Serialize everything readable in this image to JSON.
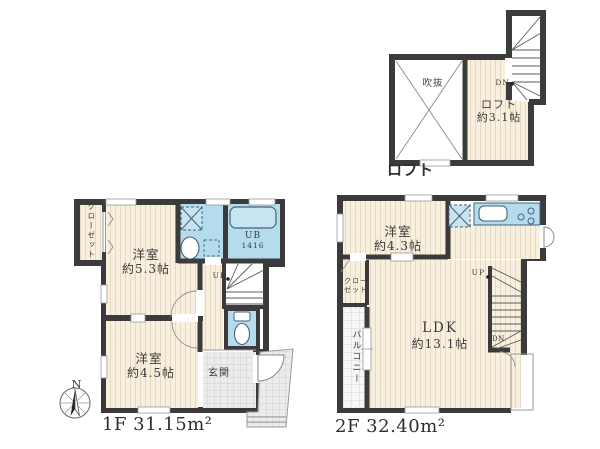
{
  "colors": {
    "wall": "#3b3b3b",
    "floor": "#f8efde",
    "floor_stripe": "#e4d9c2",
    "wet_area": "#b5dcec",
    "wet_outline": "#41637a",
    "tile_bg": "#ececec",
    "tile_line": "#c8c8c8",
    "text": "#3a3a3a"
  },
  "loft": {
    "plan_title": "ロフト",
    "void_label": "吹抜",
    "room_label": "ロフト",
    "room_size": "約3.1帖",
    "dn_label": "DN"
  },
  "floor1": {
    "area_label": "1F 31.15m²",
    "closet_label": "クローゼット",
    "room1_label": "洋室",
    "room1_size": "約5.3帖",
    "room2_label": "洋室",
    "room2_size": "約4.5帖",
    "ub_label": "UB",
    "ub_size": "1416",
    "up_label": "UP",
    "entrance_label": "玄関"
  },
  "floor2": {
    "area_label": "2F 32.40m²",
    "room_label": "洋室",
    "room_size": "約4.3帖",
    "closet_label_line1": "クロー",
    "closet_label_line2": "ゼット",
    "balcony_label": "バルコニー",
    "ldk_label": "LDK",
    "ldk_size": "約13.1帖",
    "up_label": "UP",
    "dn_label": "DN"
  },
  "compass": {
    "north_label": "N"
  },
  "icons": {
    "washing_machine": "washing-machine-icon",
    "washbasin": "washbasin-icon",
    "bathtub": "bathtub-icon",
    "toilet": "toilet-icon",
    "refrigerator": "refrigerator-icon",
    "sink": "sink-icon",
    "stove": "stove-icon",
    "compass": "compass-rose-icon"
  }
}
